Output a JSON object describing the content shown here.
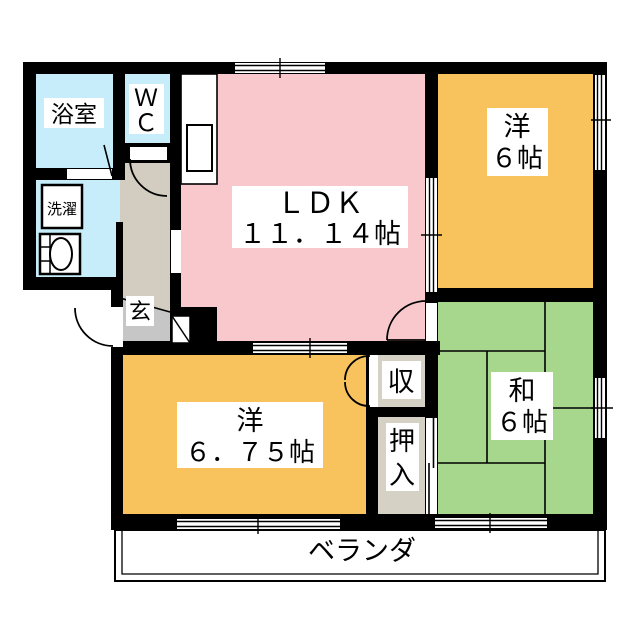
{
  "floorplan": {
    "rooms": {
      "bath": {
        "label": "浴室"
      },
      "wc": {
        "line1": "Ｗ",
        "line2": "Ｃ"
      },
      "laundry": {
        "label": "洗濯"
      },
      "entrance": {
        "label": "玄"
      },
      "ldk": {
        "label": "ＬＤＫ",
        "size": "１１．１４帖"
      },
      "western_6": {
        "label": "洋",
        "size": "６帖"
      },
      "japanese_6": {
        "label": "和",
        "size": "６帖"
      },
      "western_675": {
        "label": "洋",
        "size": "６．７５帖"
      },
      "storage": {
        "label": "収"
      },
      "closet": {
        "line1": "押",
        "line2": "入"
      },
      "veranda": {
        "label": "ベランダ"
      }
    },
    "colors": {
      "ldk": "#f9c8cc",
      "western": "#f8c25d",
      "tatami": "#a7d78d",
      "wet": "#c6edf9",
      "hall": "#d3cdc1",
      "genkan": "#c6c6c6",
      "closet": "#d5d1c5",
      "wall": "#000000"
    }
  }
}
